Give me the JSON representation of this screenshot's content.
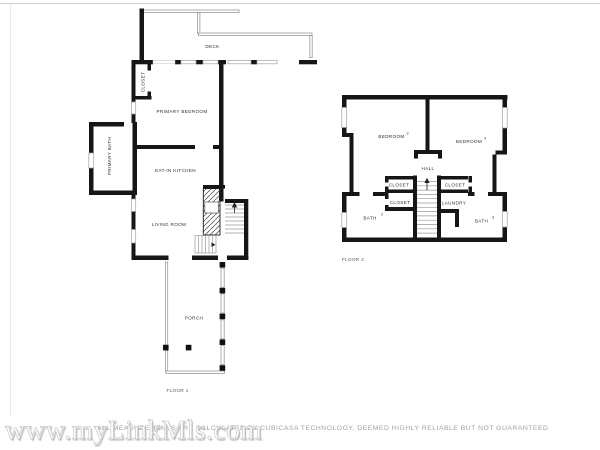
{
  "floor1": {
    "label": "FLOOR 1",
    "rooms": {
      "deck": "DECK",
      "closet": "CLOSET",
      "primary_bedroom": "PRIMARY BEDROOM",
      "primary_bath": "PRIMARY BATH",
      "eat_in_kitchen": "EAT-IN KITCHEN",
      "living_room": "LIVING ROOM",
      "porch": "PORCH"
    }
  },
  "floor2": {
    "label": "FLOOR 2",
    "rooms": {
      "bedroom2": {
        "label": "BEDROOM",
        "sup": "2"
      },
      "bedroom3": {
        "label": "BEDROOM",
        "sup": "3"
      },
      "hall": "HALL",
      "closet_upper_left": "CLOSET",
      "closet_lower_left": "CLOSET",
      "closet_right": "CLOSET",
      "laundry": "LAUNDRY",
      "bath2": {
        "label": "BATH",
        "sup": "2"
      },
      "bath3": {
        "label": "BATH",
        "sup": "3"
      }
    }
  },
  "footer": {
    "watermark": "www.myLinkMls.com",
    "disclaimer": "ALL MEASUREMENTS ARE CALCULATED BY CUBICASA TECHNOLOGY, DEEMED HIGHLY RELIABLE BUT NOT GUARANTEED."
  },
  "colors": {
    "wall": "#161616",
    "thin_line": "#9a9a9a",
    "window_stroke": "#a0a0a0",
    "label_text": "#2e2e2e",
    "watermark_text": "#ffffff",
    "disclaimer_text": "#a2a2a2"
  }
}
